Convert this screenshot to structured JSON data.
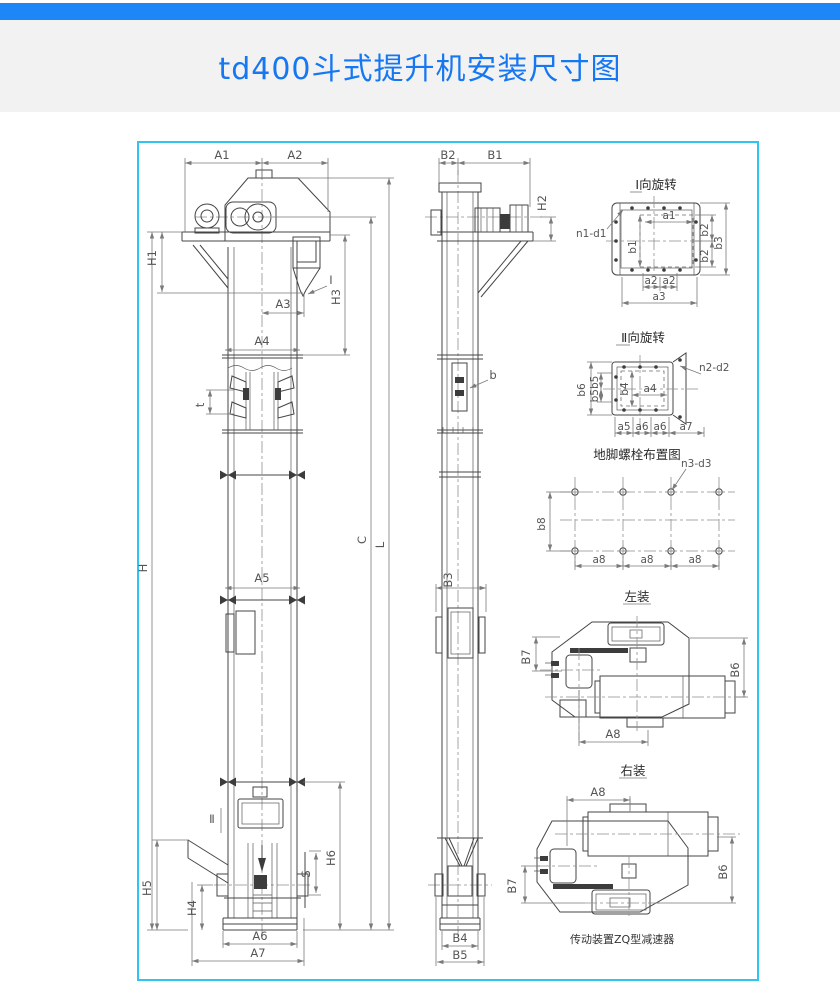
{
  "page": {
    "accent_bar_color": "#1d87f7",
    "frame_border_color": "#2fc5f1",
    "title": "td400斗式提升机安装尺寸图",
    "title_color": "#1677f2"
  },
  "front_view": {
    "dims": {
      "a1": "A1",
      "a2": "A2",
      "a3": "A3",
      "a4": "A4",
      "a5": "A5",
      "a6": "A6",
      "a7": "A7",
      "h": "H",
      "h1": "H1",
      "h3": "H3",
      "h4": "H4",
      "h5": "H5",
      "h6": "H6",
      "s": "S",
      "t": "t",
      "c": "C",
      "l": "L"
    },
    "callouts": {
      "section_i": "Ⅰ",
      "section_ii": "Ⅱ"
    }
  },
  "side_view": {
    "dims": {
      "b1": "B1",
      "b2": "B2",
      "b3": "B3",
      "b4": "B4",
      "b5": "B5",
      "h2": "H2",
      "b": "b"
    }
  },
  "detail_rotation_i": {
    "title": "Ⅰ向旋转",
    "bolt_callout": "n1-d1",
    "dims": {
      "a1": "a1",
      "a2_left": "a2",
      "a2_right": "a2",
      "a3": "a3",
      "b1": "b1",
      "b2_upper": "b2",
      "b2_lower": "b2",
      "b3": "b3"
    }
  },
  "detail_rotation_ii": {
    "title": "Ⅱ向旋转",
    "bolt_callout": "n2-d2",
    "dims": {
      "a4": "a4",
      "a5": "a5",
      "a6_left": "a6",
      "a6_right": "a6",
      "a7": "a7",
      "b4": "b4",
      "b5b5": "b5b5",
      "b6": "b6"
    }
  },
  "anchor_bolt_plan": {
    "title": "地脚螺栓布置图",
    "bolt_callout": "n3-d3",
    "dims": {
      "b8": "b8",
      "a8_1": "a8",
      "a8_2": "a8",
      "a8_3": "a8"
    }
  },
  "left_mount": {
    "title": "左装",
    "dims": {
      "b7": "B7",
      "b6": "B6",
      "a8": "A8"
    }
  },
  "right_mount": {
    "title": "右装",
    "dims": {
      "a8": "A8",
      "b7": "B7",
      "b6": "B6"
    },
    "caption": "传动装置ZQ型减速器"
  }
}
